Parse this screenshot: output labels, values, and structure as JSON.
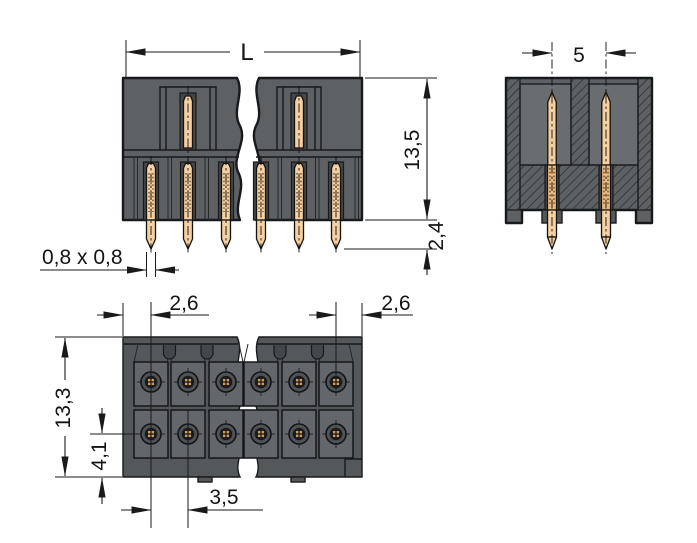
{
  "drawing": {
    "labels": {
      "overall_length": "L",
      "row_spacing": "5",
      "height_above_board": "13,5",
      "pin_protrusion": "2,4",
      "pin_cross_section": "0,8 x 0,8",
      "edge_to_first_pin": "2,6",
      "last_pin_to_edge": "2,6",
      "overall_depth": "13,3",
      "row_offset_from_edge": "4,1",
      "pin_pitch": "3,5"
    },
    "colors": {
      "background": "#ffffff",
      "housing_gray": "#5e6164",
      "housing_recess": "#44474a",
      "housing_cavity": "#6a6d70",
      "pin_copper": "#f5d0a2",
      "line_black": "#1a1a1a"
    }
  }
}
